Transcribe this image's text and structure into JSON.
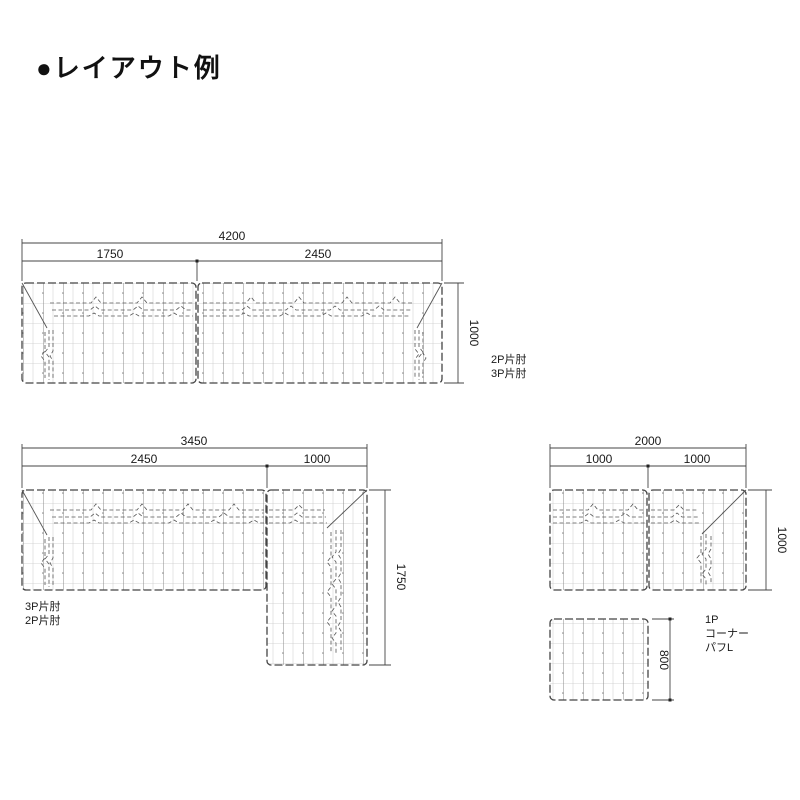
{
  "title": "●レイアウト例",
  "layout_top": {
    "dim_total": "4200",
    "dim_seg1": "1750",
    "dim_seg2": "2450",
    "dim_depth": "1000",
    "label1": "2P片肘",
    "label2": "3P片肘"
  },
  "layout_left": {
    "dim_total": "3450",
    "dim_seg1": "2450",
    "dim_seg2": "1000",
    "dim_depth": "1750",
    "label1": "3P片肘",
    "label2": "2P片肘"
  },
  "layout_right": {
    "dim_total": "2000",
    "dim_seg1": "1000",
    "dim_seg2": "1000",
    "dim_depth": "1000",
    "ottoman_dim": "800",
    "label1": "1P",
    "label2": "コーナー",
    "label3": "パフL"
  },
  "colors": {
    "background": "#ffffff",
    "line": "#444444",
    "text": "#1a1a1a"
  }
}
